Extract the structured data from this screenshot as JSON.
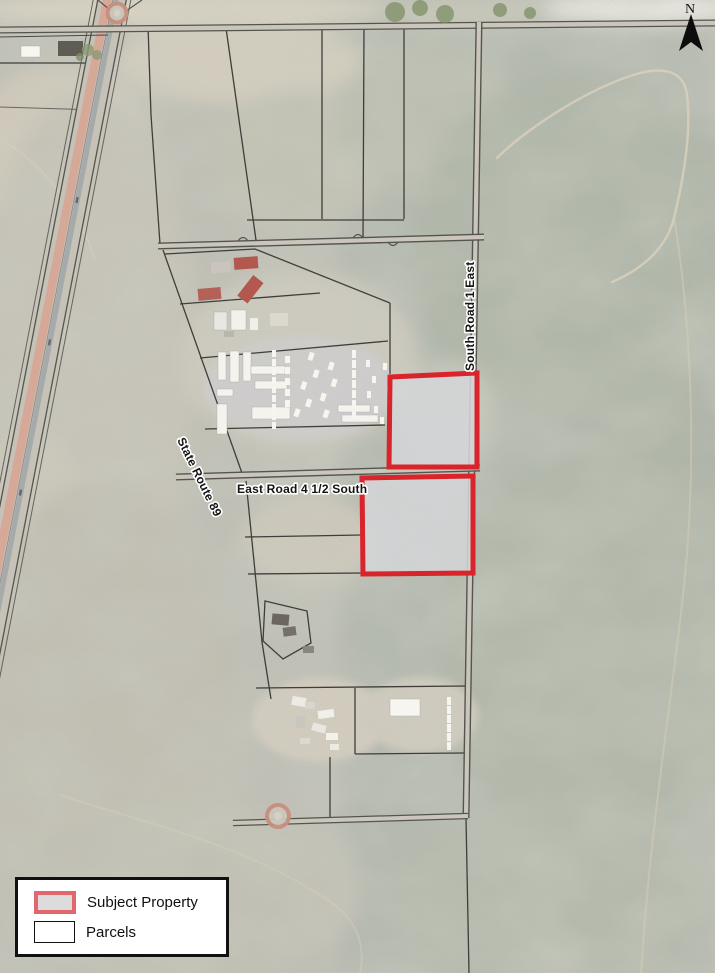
{
  "map": {
    "labels": {
      "state_route_89": "State Route 89",
      "south_road_1_east": "South Road 1 East",
      "east_road_4_half_south": "East Road 4 1/2 South"
    },
    "north_arrow": {
      "label": "N"
    },
    "colors": {
      "subject_outline": "#d8242a",
      "subject_fill": "#d4d5d7",
      "parcel_line": "#3e3e3a",
      "road_edge": "#55554f",
      "road_fill": "#cac6bc",
      "highway_red_lane": "#d8a392",
      "highway_asphalt": "#9aa2a6",
      "terrain_west": "#c5c3b8",
      "terrain_east": "#b7bbb0",
      "legend_swatch_border": "#e2666d"
    }
  },
  "legend": {
    "items": [
      {
        "label": "Subject Property"
      },
      {
        "label": "Parcels"
      }
    ]
  }
}
